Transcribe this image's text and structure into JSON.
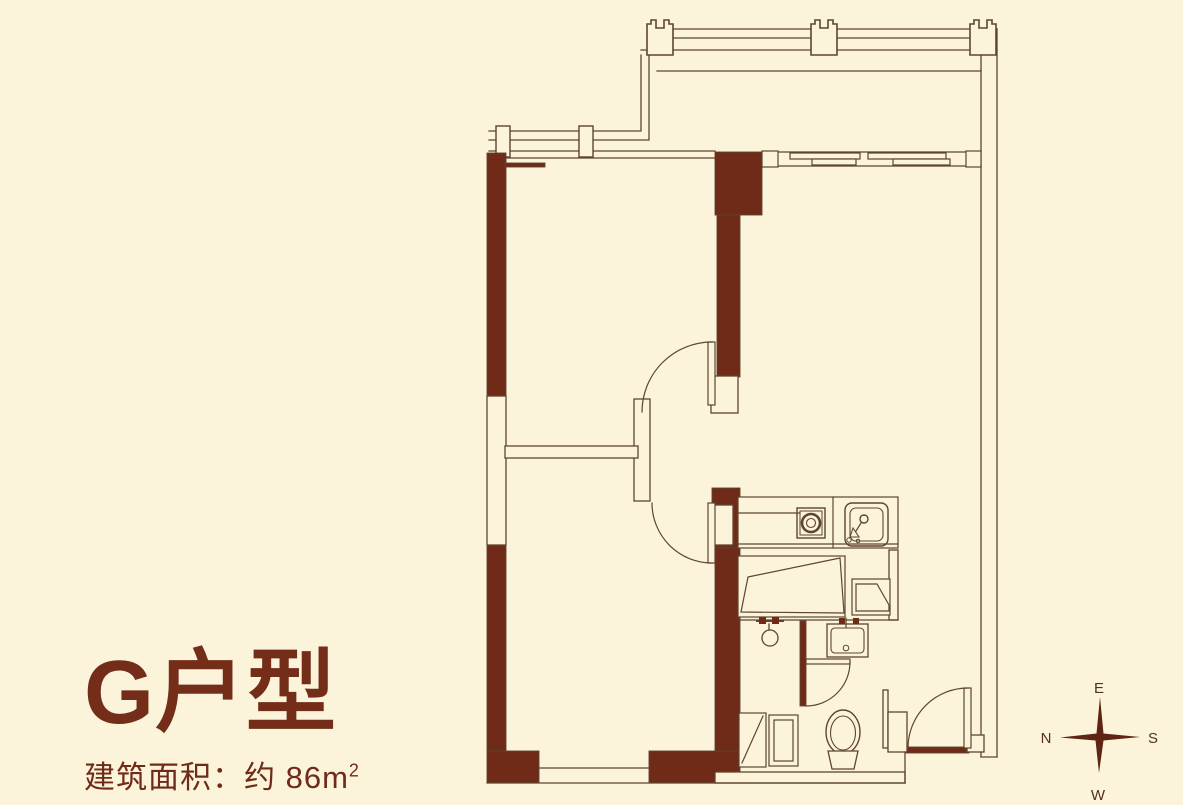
{
  "title": {
    "unit_name": "G户型",
    "area_label": "建筑面积：约 86m",
    "area_sup": "2"
  },
  "compass": {
    "top": "E",
    "right": "S",
    "bottom": "W",
    "left": "N"
  },
  "colors": {
    "background": "#FBF4DB",
    "wall_fill": "#6F2B18",
    "line": "#5E4530",
    "text": "#732D18",
    "compass_star": "#5E2414"
  },
  "floor_plan": {
    "type": "apartment-floor-plan",
    "elements": [
      "balcony-railing",
      "bay-window",
      "sliding-balcony-door",
      "bedroom-door-arc-upper",
      "bedroom-door-arc-lower",
      "bathroom-door-arc",
      "entry-door-arc",
      "cooktop-icon",
      "kitchen-sink-icon",
      "washbasin-icon",
      "toilet-icon",
      "shower-head-icon",
      "cabinet-counter",
      "washing-machine",
      "compass-rose-icon"
    ]
  }
}
